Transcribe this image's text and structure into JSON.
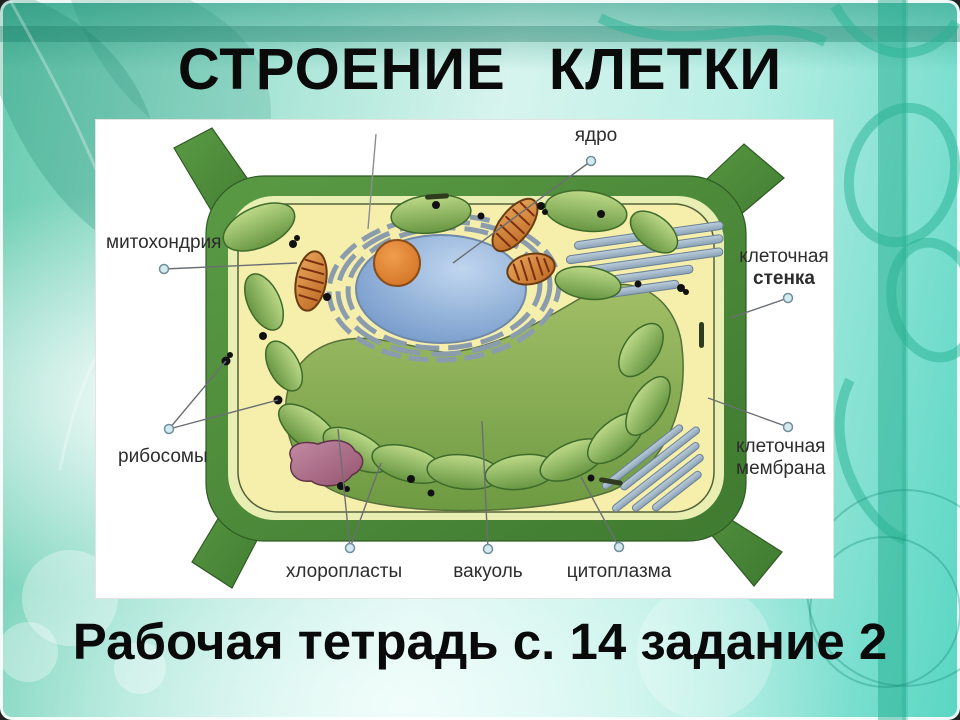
{
  "slide": {
    "title": "СТРОЕНИЕ КЛЕТКИ",
    "caption": "Рабочая тетрадь с. 14 задание 2"
  },
  "diagram": {
    "labels": {
      "nucleus": "ядро",
      "mitochondrion": "митохондрия",
      "ribosomes": "рибосомы",
      "cell_wall": [
        "клеточная",
        "стенка"
      ],
      "cell_membrane": [
        "клеточная",
        "мембрана"
      ],
      "chloroplasts": "хлоропласты",
      "vacuole": "вакуоль",
      "cytoplasm": "цитоплазма"
    },
    "colors": {
      "background_teal": "#5ecfb6",
      "panel_white": "#ffffff",
      "cell_wall_green": "#4e8f3c",
      "inner_wall_band": "#e9efb2",
      "cytoplasm_yellow": "#f6efac",
      "vacuole_green": "#84a855",
      "nucleus_blue": "#7fa4d4",
      "nucleolus_orange": "#dd8133",
      "chloroplast_green": "#8db95e",
      "mitochondrion_orange": "#cf7a2e",
      "er_blue_gray": "#a4bacb",
      "ribosome_black": "#111111",
      "label_text": "#2d2d2d",
      "title_text": "#0a0a0a"
    }
  }
}
